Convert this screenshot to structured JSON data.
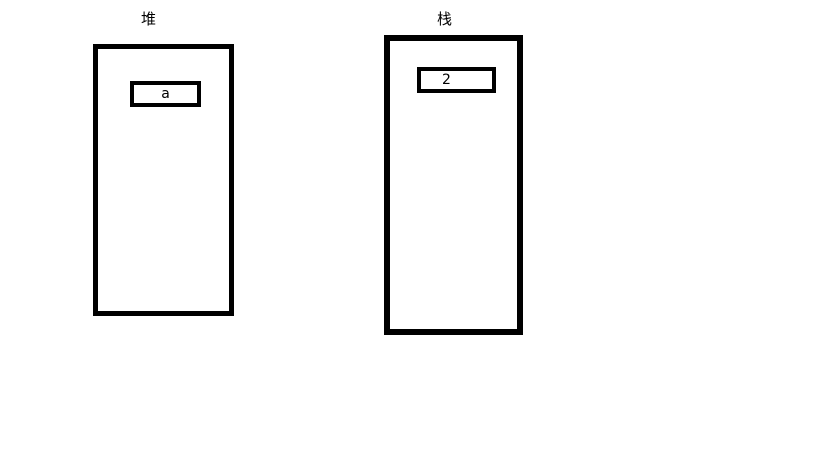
{
  "canvas": {
    "background_color": "#ffffff",
    "line_color": "#000000"
  },
  "heap": {
    "label": "堆",
    "slots": [
      {
        "value": "a"
      }
    ]
  },
  "stack": {
    "label": "栈",
    "slots": [
      {
        "value": "2"
      }
    ]
  }
}
